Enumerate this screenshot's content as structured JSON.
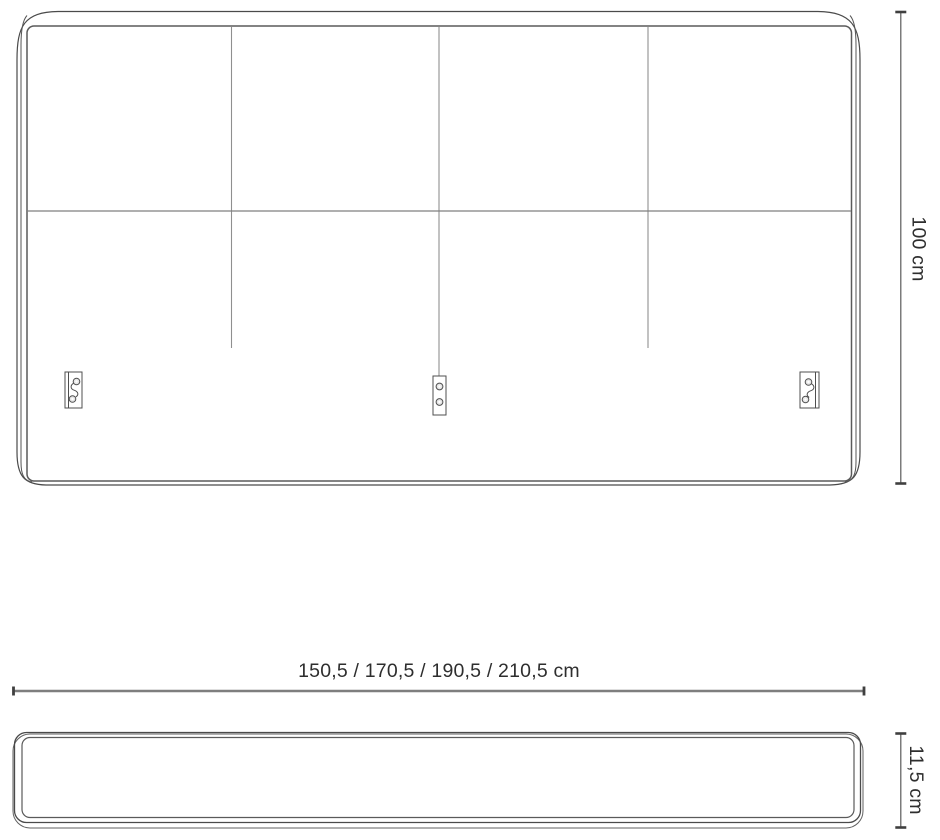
{
  "drawing": {
    "type": "furniture-technical-drawing",
    "views": {
      "front_view": "headboard-front-view",
      "side_view": "headboard-side-view"
    },
    "dimensions": {
      "height_label": "100 cm",
      "width_label": "150,5 / 170,5 / 190,5 / 210,5 cm",
      "depth_label": "11,5 cm"
    },
    "icons": {
      "mounting_brackets": [
        "keyhole-bracket-left",
        "screw-plate-bracket-center",
        "keyhole-bracket-right"
      ]
    },
    "colors": {
      "background": "#ffffff",
      "outline": "#4a4a4a",
      "grid_line": "#9a9a9a",
      "dimension_line": "#7e7e7e",
      "dimension_tick": "#3f3f3f",
      "text": "#2e2e2e"
    }
  }
}
